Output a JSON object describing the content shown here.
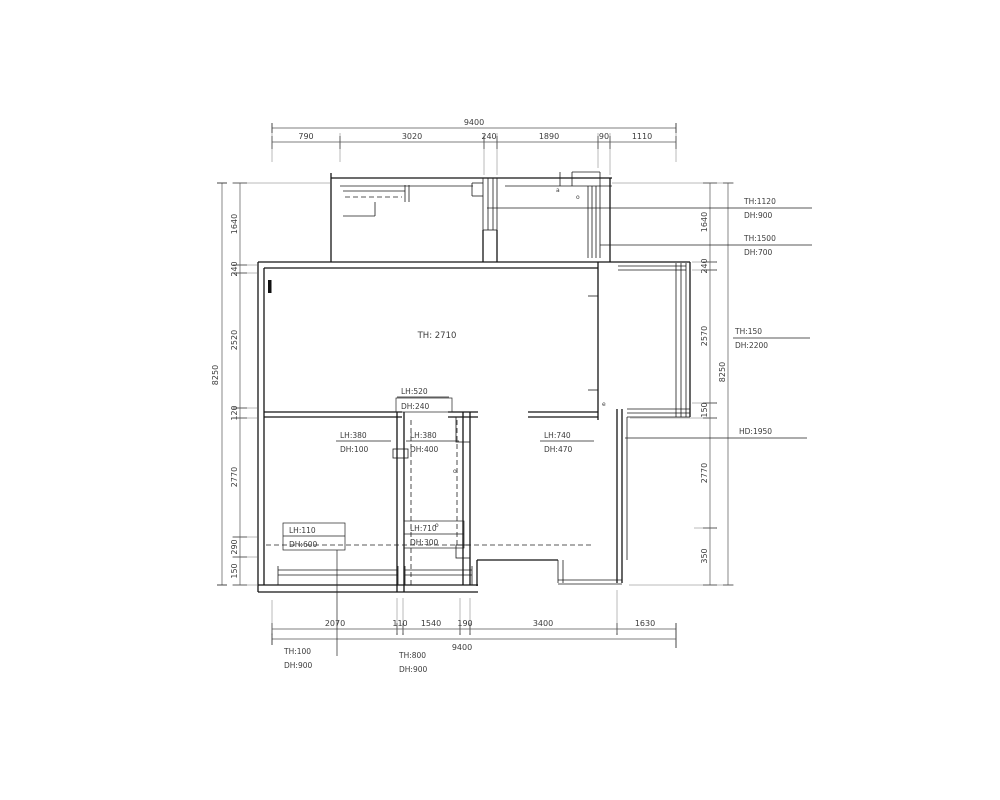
{
  "drawing": {
    "type": "architectural-floor-plan-survey",
    "background_color": "#ffffff",
    "line_color": "#151515",
    "dim_text_color": "#3c3c3c"
  },
  "dims": {
    "top": {
      "total": "9400",
      "segs": [
        "790",
        "3020",
        "240",
        "1890",
        "90",
        "1110"
      ]
    },
    "bottom": {
      "total": "9400",
      "segs": [
        "2070",
        "110",
        "1540",
        "190",
        "3400",
        "1630"
      ]
    },
    "left": {
      "total": "8250",
      "segs": [
        "1640",
        "240",
        "2520",
        "120",
        "2770",
        "290",
        "150"
      ]
    },
    "right": {
      "total": "8250",
      "segs": [
        "1640",
        "240",
        "2570",
        "150",
        "2770",
        "350"
      ]
    }
  },
  "ann": {
    "r1t": "TH:1120",
    "r1b": "DH:900",
    "r2t": "TH:1500",
    "r2b": "DH:700",
    "r3t": "TH:150",
    "r3b": "DH:2200",
    "r4t": "HD:1950",
    "b1t": "TH:100",
    "b1b": "DH:900",
    "b2t": "TH:800",
    "b2b": "DH:900"
  },
  "labels": {
    "room": "TH: 2710",
    "l0t": "LH:520",
    "l0b": "DH:240",
    "l1t": "LH:380",
    "l1b": "DH:100",
    "l2t": "LH:380",
    "l2b": "DH:400",
    "l3t": "LH:740",
    "l3b": "DH:470",
    "l4t": "LH:110",
    "l4b": "DH:600",
    "l5t": "LH:710",
    "l5b": "DH:300"
  },
  "marks": [
    "a",
    "o",
    "e",
    "o",
    "o"
  ]
}
